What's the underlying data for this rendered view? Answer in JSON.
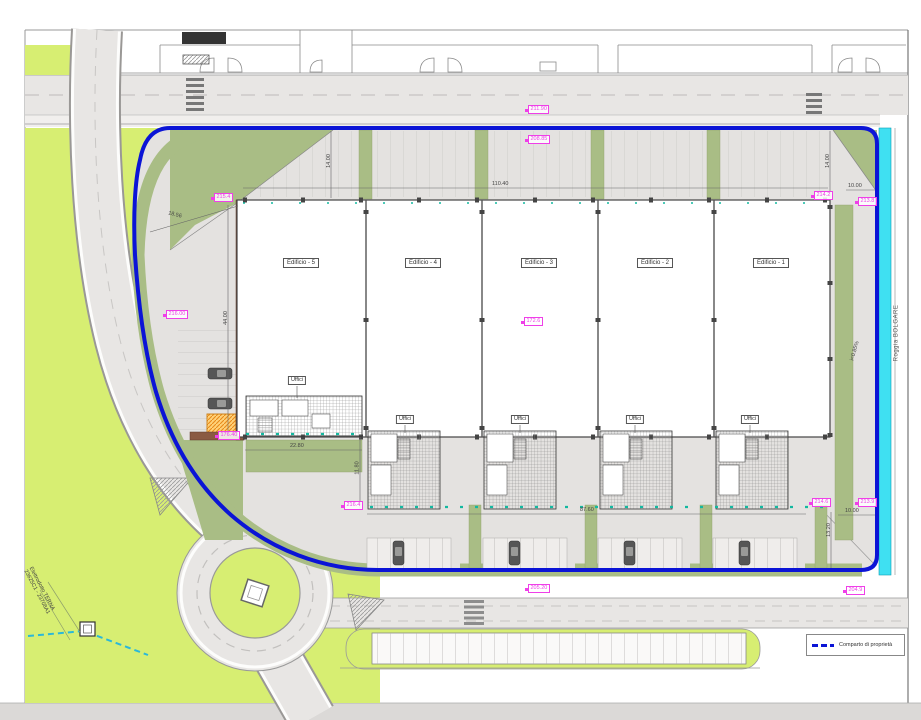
{
  "title": "Planimetria di progetto - comparto industriale",
  "colors": {
    "boundary_blue": "#0b14d6",
    "canal_cyan": "#3fe0f2",
    "green_bright": "#d7ee72",
    "green_sage": "#a9bd85",
    "road_gray": "#e8e6e4",
    "yard_gray": "#e4e2e0",
    "quota_magenta": "#ef3fe8",
    "wall_brown": "#8a5a42",
    "cabin_orange": "#f0a832",
    "teal_marks": "#14b8a0"
  },
  "buildings": [
    {
      "label": "Edificio - 5"
    },
    {
      "label": "Edificio - 4"
    },
    {
      "label": "Edificio - 3"
    },
    {
      "label": "Edificio - 2"
    },
    {
      "label": "Edificio - 1"
    }
  ],
  "office_label": "Uffici",
  "canal_label": "Roggia BOLGARE",
  "powerline": {
    "line1": "Elettrodotto TERNA",
    "line2": "23625C1 - 23708A1"
  },
  "legend": {
    "items": [
      {
        "label": "Comparto di proprietà",
        "swatch_color": "#0b14d6",
        "swatch_style": "dashed-line"
      }
    ]
  },
  "dimensions": [
    {
      "text": "110.40"
    },
    {
      "text": "14.00"
    },
    {
      "text": "14.00"
    },
    {
      "text": "10.00"
    },
    {
      "text": "44.00"
    },
    {
      "text": "22.80"
    },
    {
      "text": "11.80"
    },
    {
      "text": "87.60"
    },
    {
      "text": "10.00"
    },
    {
      "text": "13.20"
    },
    {
      "text": "18.56"
    },
    {
      "text": "i=0.85%"
    }
  ],
  "quotas": [
    {
      "text": "211.90"
    },
    {
      "text": "208.85"
    },
    {
      "text": "215.4"
    },
    {
      "text": "216.00"
    },
    {
      "text": "172.6"
    },
    {
      "text": "176.40"
    },
    {
      "text": "216.4"
    },
    {
      "text": "214.2"
    },
    {
      "text": "213.8"
    },
    {
      "text": "214.6"
    },
    {
      "text": "213.9"
    },
    {
      "text": "205.20"
    },
    {
      "text": "204.9"
    }
  ]
}
